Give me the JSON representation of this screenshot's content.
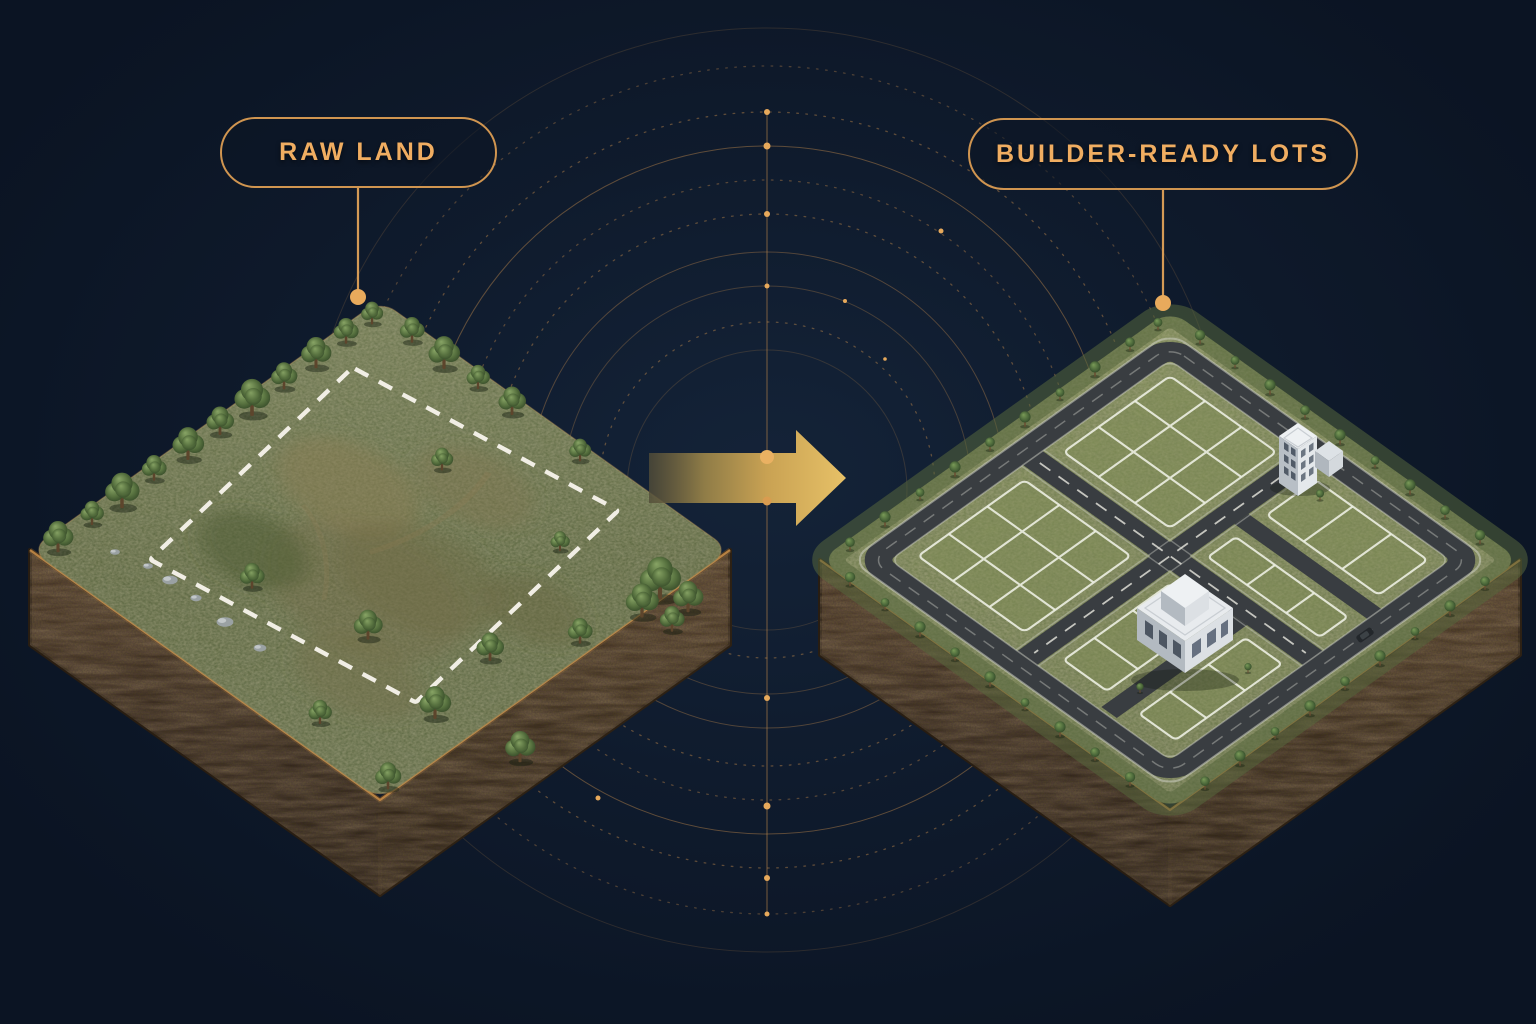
{
  "page": {
    "type": "land-development-infographic",
    "background_color": "#0f1b2d",
    "accent_gold": "#d09550",
    "accent_gold_bright": "#e7c167",
    "boundary_white": "#f1eee5"
  },
  "pills": {
    "left": {
      "label": "RAW LAND"
    },
    "right": {
      "label": "BUILDER-READY LOTS"
    }
  },
  "illustrations": {
    "left_block": {
      "name": "raw-land-parcel",
      "boundary": "white-dashed-outline"
    },
    "right_block": {
      "name": "builder-ready-lots-parcel",
      "features": "roads, subdivided lots, two buildings, street trees"
    },
    "arrow": {
      "name": "transformation-arrow",
      "direction": "right",
      "color": "#d9a94f"
    },
    "rings": {
      "name": "radar-rings",
      "color": "#c28a4c"
    }
  }
}
